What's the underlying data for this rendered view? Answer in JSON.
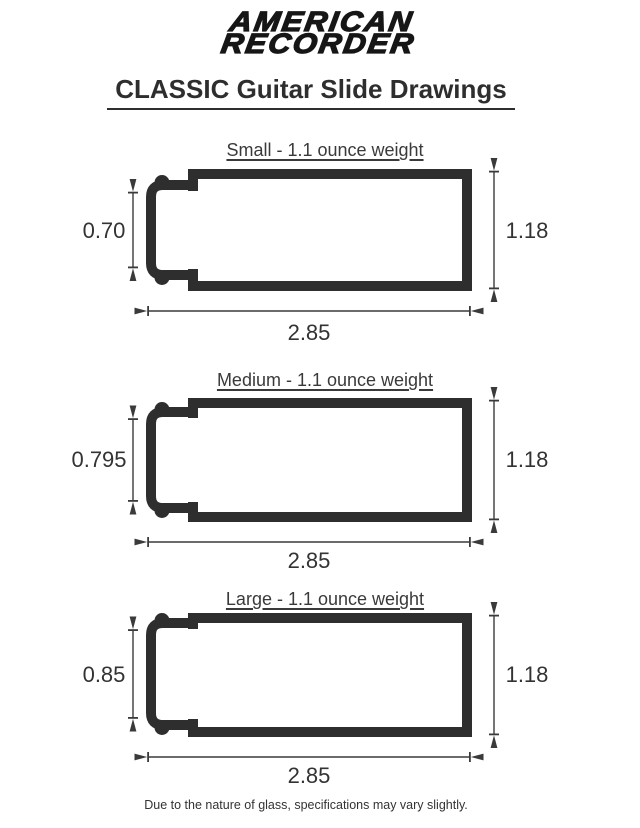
{
  "brand": {
    "line1": "AMERICAN",
    "line2": "RECORDER"
  },
  "page_title": "CLASSIC Guitar Slide Drawings",
  "footnote": "Due to the nature of glass, specifications may vary slightly.",
  "colors": {
    "ink": "#2e2e2e",
    "dimension_lines": "#3a3a3a",
    "text": "#333333",
    "background": "#ffffff"
  },
  "drawings": [
    {
      "size": "Small",
      "heading": "Small - 1.1 ounce weight",
      "opening_height": "0.70",
      "outer_height": "1.18",
      "length": "2.85"
    },
    {
      "size": "Medium",
      "heading": "Medium - 1.1 ounce weight",
      "opening_height": "0.795",
      "outer_height": "1.18",
      "length": "2.85"
    },
    {
      "size": "Large",
      "heading": "Large - 1.1 ounce weight",
      "opening_height": "0.85",
      "outer_height": "1.18",
      "length": "2.85"
    }
  ]
}
